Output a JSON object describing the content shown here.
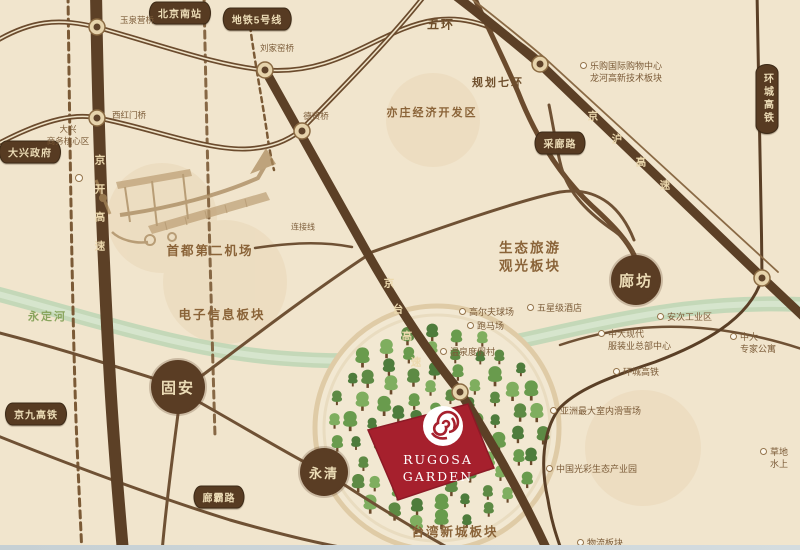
{
  "logo": {
    "line1": "RUGOSA",
    "line2": "GARDEN"
  },
  "badges": {
    "guan": "固安",
    "yongqing": "永清",
    "langfang": "廊坊"
  },
  "banners": {
    "daxing_gov": "大兴政府",
    "beijing_south_station": "北京南站",
    "metro_line5": "地铁5号线",
    "cailang_road": "采廊路",
    "ring_city_hsr": "环城高铁",
    "jingjiu_hsr": "京九高铁",
    "langba_road": "廊霸路"
  },
  "roads": {
    "jingkai": "京开高速",
    "jingtai": "京台高速",
    "jinghu": "京沪高速"
  },
  "ring_roads": {
    "wuhuan": "五环",
    "planned_qihuan": "规划七环"
  },
  "bridges": {
    "yuquanying": "玉泉营桥",
    "liujiayao": "刘家窑桥",
    "xihongmen": "西红门桥",
    "dexian": "德贤桥"
  },
  "areas": {
    "yizhuang": "亦庄经济开发区",
    "electronic_info": "电子信息板块",
    "eco_tourism": [
      "生态旅游",
      "观光板块"
    ],
    "second_airport": "首都第二机场",
    "taiwan_new_town": "台湾新城板块",
    "daxing_core": [
      "大兴",
      "商务核心区"
    ],
    "connection_line": "连接线",
    "yongding_river": "永定河"
  },
  "pois": {
    "legou_mall": [
      "乐购国际购物中心",
      "龙河高新技术板块"
    ],
    "golf_course": "高尔夫球场",
    "five_star_hotel": "五星级酒店",
    "racecourse": "跑马场",
    "hot_spring_resort": "温泉度假村",
    "anci_industrial": "安次工业区",
    "zhongda_hq": [
      "中大现代",
      "服装业总部中心"
    ],
    "zhongda_expert_apartment": [
      "中大",
      "专家公寓"
    ],
    "ring_city_hsr_poi": "环城高铁",
    "asia_indoor_ski": "亚洲最大室内滑雪场",
    "guangcai_eco_park": "中国光彩生态产业园",
    "grass_water_park": [
      "草地",
      "水上"
    ],
    "logistics_area": "物流板块"
  },
  "colors": {
    "background": "#f1e5cd",
    "road_brown": "#5c4026",
    "banner_brown": "#573b22",
    "accent_red": "#a6202d",
    "river_green": "#bcd6b4",
    "tree_greens": [
      "#4e7c3c",
      "#699b4d",
      "#7fae5f",
      "#5d8a44"
    ]
  }
}
